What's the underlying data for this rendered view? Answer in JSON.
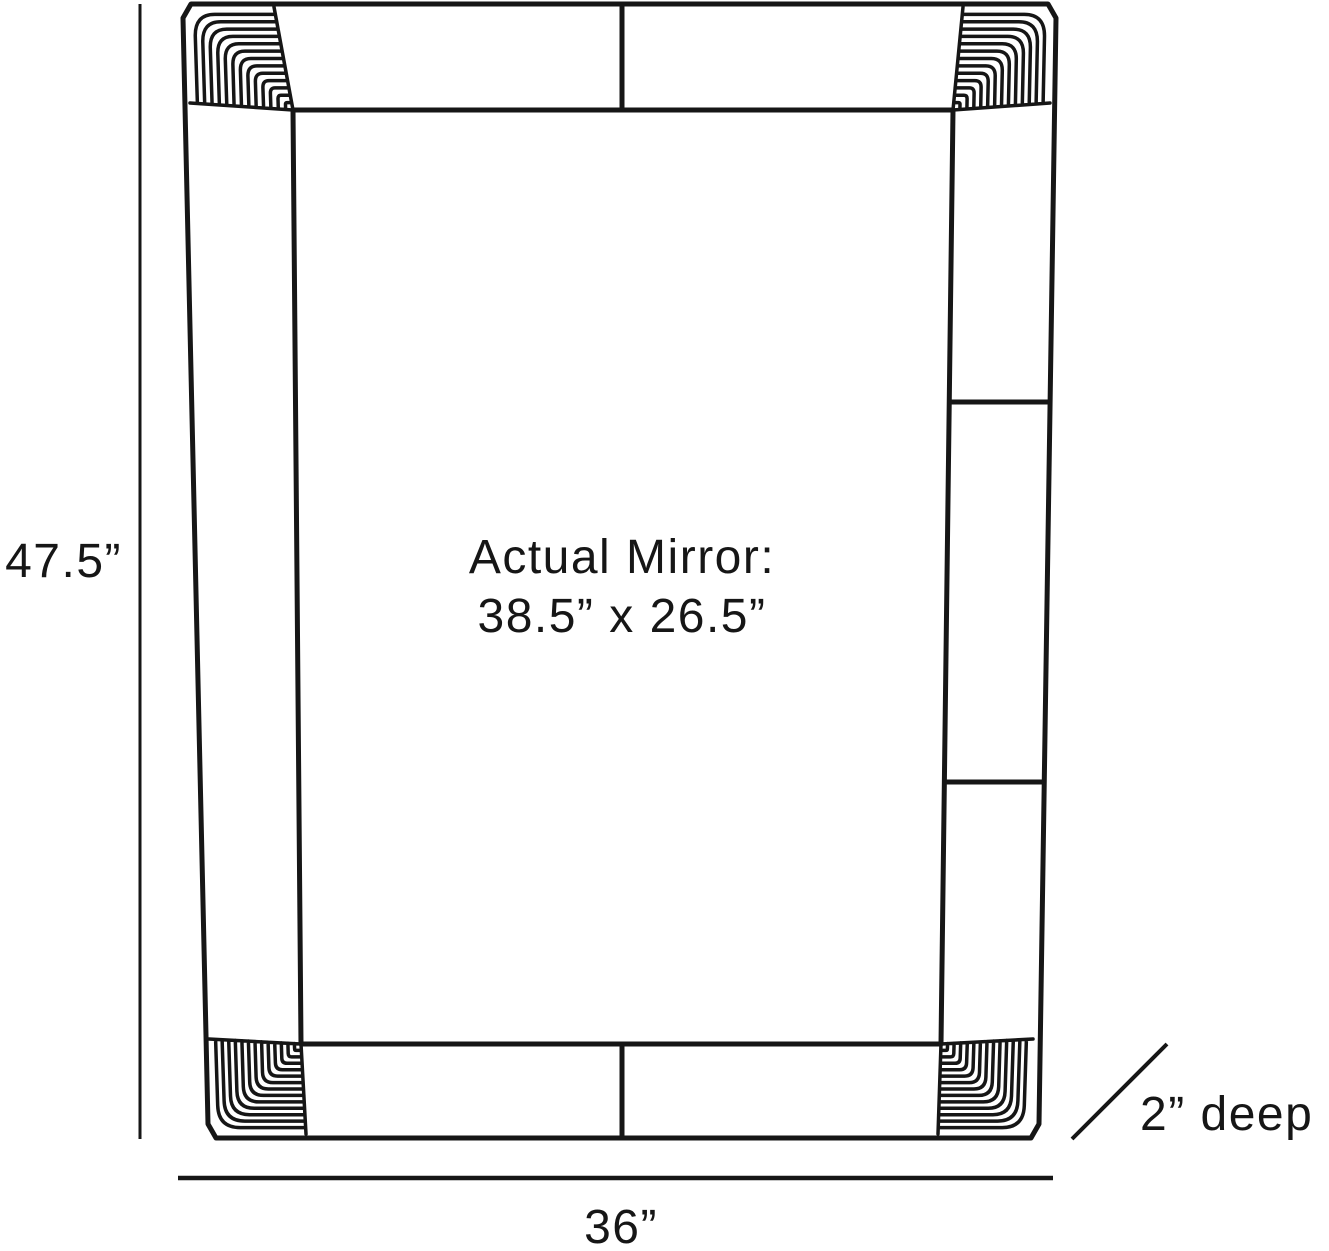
{
  "diagram": {
    "kind": "mirror-dimension-diagram",
    "height_label": "47.5”",
    "width_label": "36”",
    "depth_label": "2” deep",
    "mirror_note_line1": "Actual Mirror:",
    "mirror_note_line2": "38.5” x 26.5”",
    "ink_color": "#161616",
    "background_color": "#ffffff"
  }
}
